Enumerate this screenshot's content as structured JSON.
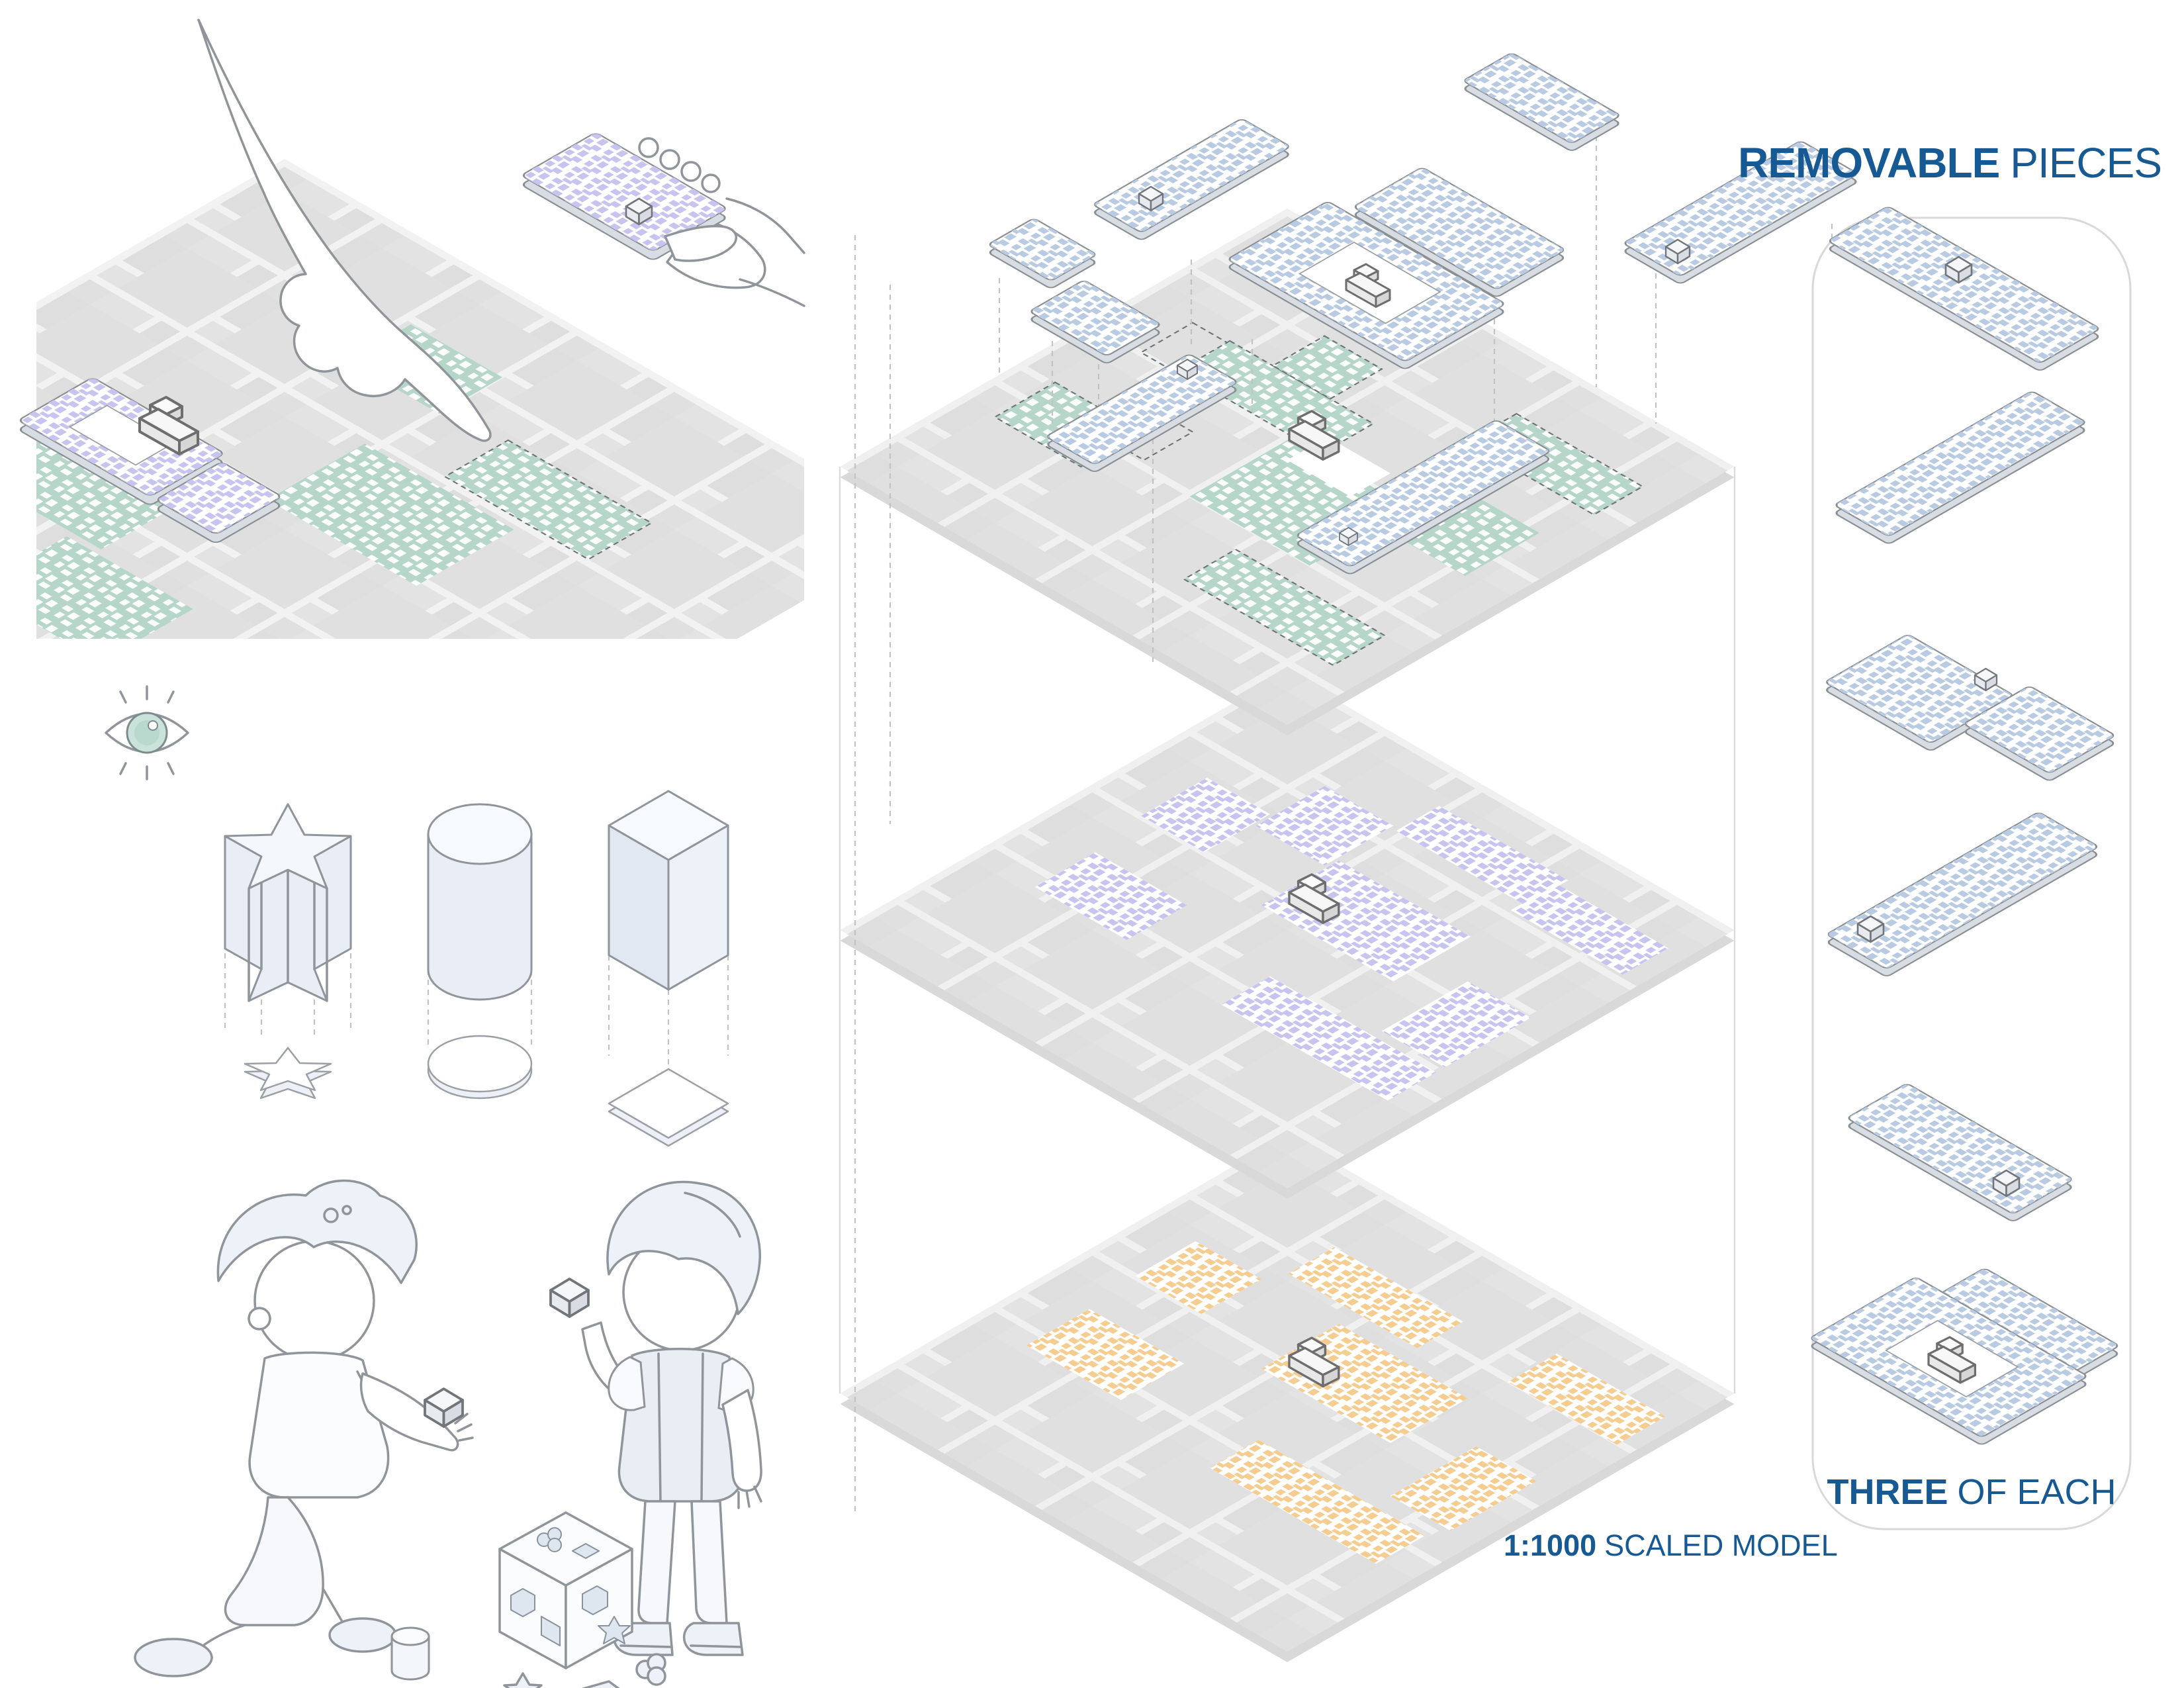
{
  "title": {
    "bold": "REMOVABLE",
    "rest": "PIECES"
  },
  "footer": {
    "bold": "THREE",
    "rest": "OF EACH"
  },
  "caption": {
    "bold": "1:1000",
    "rest": "SCALED MODEL"
  },
  "colors": {
    "accent_blue": "#175A93",
    "teal": "#B7D6CA",
    "lavender": "#C7C5F0",
    "orange": "#F6CD90",
    "piece_blue": "#B9CBE2",
    "map_block_gray": "#E0E0E0",
    "map_base_gray": "#F1F1F1",
    "outline_gray": "#8A8F94"
  },
  "left_column": {
    "scenes": [
      {
        "name": "hand-placing-removable-piece"
      },
      {
        "name": "eye-icon"
      },
      {
        "name": "shape-sorter-prisms",
        "shapes": [
          "star-prism",
          "cylinder",
          "cube"
        ]
      },
      {
        "name": "children-playing-with-shape-sorter"
      }
    ]
  },
  "exploded_model": {
    "floating_pieces_count": 8,
    "layers": [
      {
        "name": "top-layer",
        "accent": "#B7D6CA"
      },
      {
        "name": "middle-layer",
        "accent": "#C7C5F0"
      },
      {
        "name": "bottom-layer",
        "accent": "#F6CD90"
      }
    ]
  },
  "removable_pieces_panel": {
    "pieces": [
      {
        "name": "long-plank-with-block"
      },
      {
        "name": "plain-plank"
      },
      {
        "name": "two-short-planks-with-connector"
      },
      {
        "name": "long-plank-with-end-block"
      },
      {
        "name": "plank-with-corner-block"
      },
      {
        "name": "plank-with-building-and-slot"
      }
    ]
  }
}
